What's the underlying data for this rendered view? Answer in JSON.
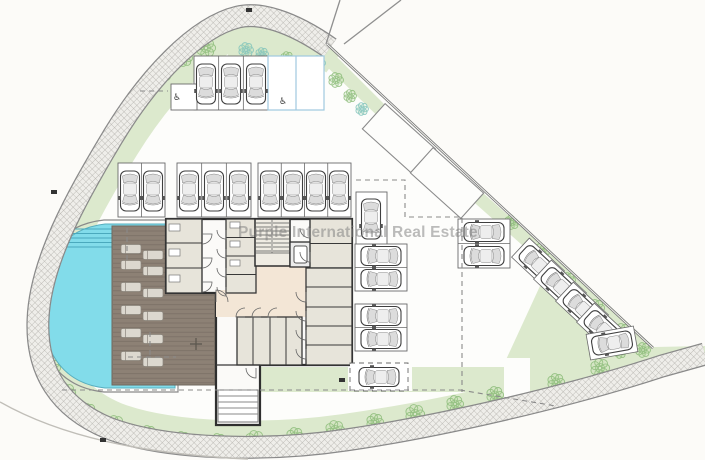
{
  "watermark": {
    "text": "Purple International Real Estate"
  },
  "palette": {
    "background": "#fcfbf8",
    "site": "#fdfdfb",
    "grass": "#dce9cd",
    "tree_green": "#8abb77",
    "tree_teal": "#7fc3bc",
    "pool_water": "#82dcea",
    "pool_step_line": "#4aa9bd",
    "deck_brown": "#8d8175",
    "lounger": "#dcd8cf",
    "walkway_fill": "#efeeea",
    "walkway_line": "#b2b0ab",
    "wall_dark": "#383838",
    "room_fill": "#e7e4da",
    "lobby_fill": "#f3e6d6",
    "stair_fill": "#efece3",
    "car_line": "#3f3f3f",
    "accessible_blue": "#9fc9e0",
    "dash_gray": "#8a8a8a"
  },
  "symbols": {
    "accessible_icon": "♿"
  },
  "plan": {
    "cars": [
      [
        206,
        84,
        180,
        0
      ],
      [
        231,
        84,
        180,
        0
      ],
      [
        256,
        84,
        180,
        0
      ],
      [
        130,
        191,
        180,
        0
      ],
      [
        153,
        191,
        180,
        0
      ],
      [
        189,
        191,
        180,
        0
      ],
      [
        214,
        191,
        180,
        0
      ],
      [
        239,
        191,
        180,
        0
      ],
      [
        270,
        191,
        180,
        0
      ],
      [
        293,
        191,
        180,
        0
      ],
      [
        316,
        191,
        180,
        0
      ],
      [
        339,
        191,
        180,
        0
      ],
      [
        371,
        219,
        180,
        0
      ],
      [
        381,
        256,
        -90,
        0
      ],
      [
        381,
        279,
        -90,
        0
      ],
      [
        381,
        316,
        -90,
        0
      ],
      [
        381,
        339,
        -90,
        0
      ],
      [
        379,
        377,
        -90,
        0
      ],
      [
        484,
        232,
        -90,
        0
      ],
      [
        484,
        256,
        -90,
        0
      ],
      [
        538,
        264,
        -47,
        1
      ],
      [
        560,
        286,
        -47,
        1
      ],
      [
        582,
        308,
        -47,
        1
      ],
      [
        603,
        329,
        -47,
        1
      ],
      [
        612,
        343,
        -100,
        1
      ]
    ],
    "stall_groups": [
      [
        194,
        56,
        74,
        54,
        3,
        "v"
      ],
      [
        268,
        56,
        56,
        54,
        2,
        "vb"
      ],
      [
        118,
        163,
        47,
        54,
        2,
        "v"
      ],
      [
        177,
        163,
        74,
        54,
        3,
        "v"
      ],
      [
        258,
        163,
        93,
        54,
        4,
        "v"
      ],
      [
        356,
        192,
        31,
        53,
        1,
        "v"
      ],
      [
        355,
        244,
        52,
        47,
        2,
        "h"
      ],
      [
        355,
        304,
        52,
        47,
        2,
        "h"
      ],
      [
        458,
        219,
        52,
        49,
        2,
        "h"
      ],
      [
        350,
        363,
        58,
        28,
        1,
        "hd"
      ],
      [
        171,
        84,
        26,
        26,
        1,
        "room"
      ]
    ],
    "labels": [
      [
        283,
        104
      ],
      [
        177,
        100
      ]
    ],
    "trees": [
      [
        206,
        48,
        9,
        0
      ],
      [
        184,
        58,
        8,
        0
      ],
      [
        163,
        72,
        9,
        0
      ],
      [
        143,
        90,
        8,
        0
      ],
      [
        124,
        110,
        9,
        0
      ],
      [
        107,
        133,
        8,
        0
      ],
      [
        93,
        156,
        9,
        0
      ],
      [
        78,
        182,
        8,
        0
      ],
      [
        66,
        210,
        9,
        0
      ],
      [
        55,
        240,
        8,
        0
      ],
      [
        47,
        272,
        9,
        0
      ],
      [
        43,
        305,
        8,
        0
      ],
      [
        44,
        338,
        9,
        0
      ],
      [
        52,
        368,
        8,
        0
      ],
      [
        66,
        393,
        9,
        0
      ],
      [
        88,
        412,
        8,
        0
      ],
      [
        115,
        425,
        9,
        0
      ],
      [
        148,
        434,
        8,
        0
      ],
      [
        182,
        440,
        8,
        0
      ],
      [
        218,
        442,
        8,
        0
      ],
      [
        255,
        440,
        9,
        0
      ],
      [
        295,
        436,
        8,
        0
      ],
      [
        335,
        430,
        9,
        0
      ],
      [
        375,
        422,
        8,
        0
      ],
      [
        415,
        414,
        9,
        0
      ],
      [
        455,
        404,
        8,
        0
      ],
      [
        495,
        395,
        8,
        0
      ],
      [
        512,
        222,
        7,
        0
      ],
      [
        541,
        252,
        8,
        0
      ],
      [
        568,
        280,
        7,
        0
      ],
      [
        596,
        308,
        8,
        0
      ],
      [
        622,
        332,
        8,
        0
      ],
      [
        643,
        350,
        7,
        0
      ],
      [
        600,
        368,
        9,
        0
      ],
      [
        556,
        382,
        8,
        0
      ],
      [
        620,
        352,
        6,
        0
      ],
      [
        246,
        50,
        7,
        1
      ],
      [
        262,
        54,
        6,
        1
      ],
      [
        287,
        58,
        6,
        0
      ],
      [
        318,
        63,
        7,
        1
      ],
      [
        336,
        80,
        7,
        0
      ],
      [
        350,
        96,
        6,
        0
      ],
      [
        362,
        109,
        6,
        1
      ],
      [
        209,
        305,
        5,
        0
      ],
      [
        209,
        352,
        5,
        0
      ]
    ],
    "loungers": [
      [
        131,
        249
      ],
      [
        153,
        255
      ],
      [
        131,
        265
      ],
      [
        153,
        271
      ],
      [
        131,
        287
      ],
      [
        153,
        293
      ],
      [
        131,
        310
      ],
      [
        153,
        316
      ],
      [
        131,
        333
      ],
      [
        153,
        339
      ],
      [
        131,
        356
      ],
      [
        153,
        362
      ]
    ],
    "door_arcs": [
      [
        202,
        234,
        10,
        0
      ],
      [
        202,
        258,
        10,
        0
      ],
      [
        202,
        282,
        10,
        0
      ],
      [
        226,
        230,
        9,
        90
      ],
      [
        226,
        249,
        9,
        90
      ],
      [
        226,
        268,
        9,
        90
      ],
      [
        226,
        287,
        9,
        90
      ],
      [
        310,
        228,
        10,
        90
      ],
      [
        310,
        252,
        10,
        90
      ],
      [
        306,
        292,
        10,
        90
      ],
      [
        306,
        311,
        10,
        90
      ],
      [
        306,
        330,
        10,
        90
      ],
      [
        306,
        349,
        10,
        90
      ],
      [
        245,
        317,
        9,
        180
      ],
      [
        261,
        317,
        9,
        180
      ],
      [
        277,
        317,
        9,
        180
      ],
      [
        216,
        302,
        12,
        270
      ],
      [
        256,
        368,
        10,
        90
      ],
      [
        174,
        86,
        10,
        0
      ]
    ],
    "fixtures": [
      [
        169,
        224,
        11,
        7
      ],
      [
        169,
        249,
        11,
        7
      ],
      [
        169,
        275,
        11,
        7
      ],
      [
        230,
        222,
        10,
        6
      ],
      [
        230,
        241,
        10,
        6
      ],
      [
        230,
        260,
        10,
        6
      ]
    ],
    "dashed_lines": [
      [
        [
          356,
          180
        ],
        [
          405,
          180
        ],
        [
          405,
          217
        ],
        [
          462,
          217
        ],
        [
          462,
          392
        ]
      ],
      [
        [
          62,
          390
        ],
        [
          460,
          390
        ]
      ],
      [
        [
          460,
          390
        ],
        [
          556,
          406
        ]
      ],
      [
        [
          140,
          91
        ],
        [
          168,
          91
        ]
      ],
      [
        [
          128,
          357
        ],
        [
          176,
          357
        ]
      ],
      [
        [
          150,
          332
        ],
        [
          150,
          357
        ]
      ],
      [
        [
          127,
          228
        ],
        [
          127,
          262
        ]
      ]
    ],
    "ticks": [
      [
        249,
        10
      ],
      [
        54,
        192
      ],
      [
        103,
        440
      ],
      [
        342,
        380
      ]
    ]
  }
}
